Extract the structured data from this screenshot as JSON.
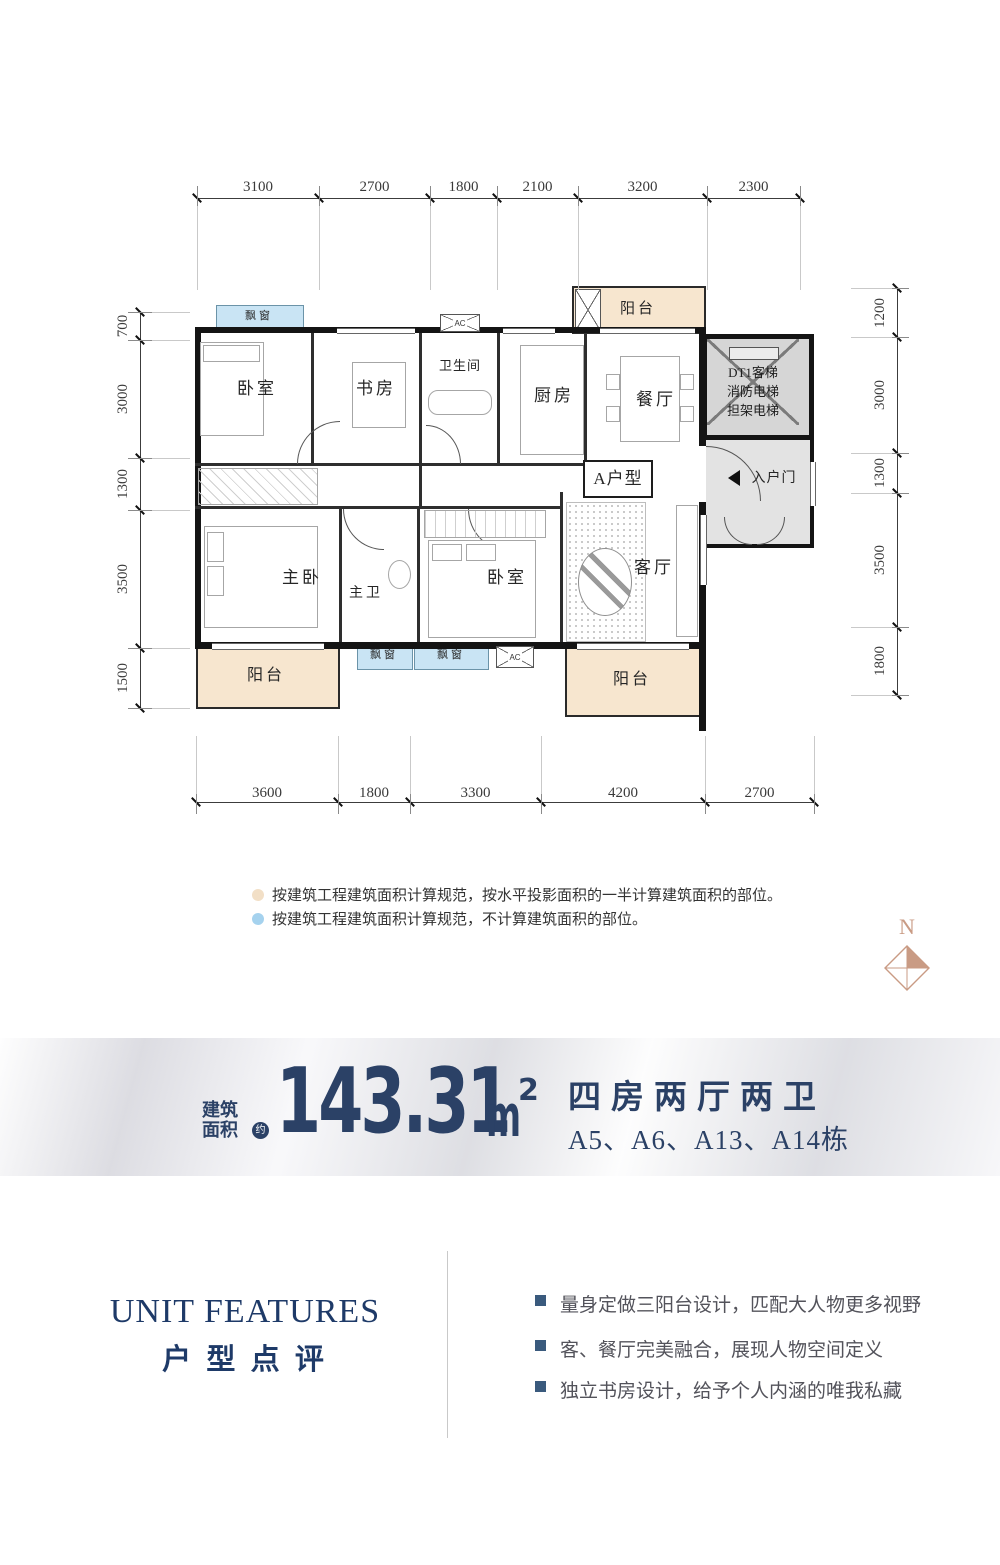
{
  "plan": {
    "unit_label": "A户型",
    "labels": {
      "bedroom": "卧室",
      "study": "书房",
      "bathroom": "卫生间",
      "kitchen": "厨房",
      "dining": "餐厅",
      "balcony": "阳台",
      "bay_window": "飘窗",
      "master_bedroom": "主卧",
      "master_bath": "主卫",
      "living": "客厅",
      "entry": "入户门",
      "ac": "AC",
      "elevator_line1": "DT1客梯",
      "elevator_line2": "消防电梯",
      "elevator_line3": "担架电梯"
    },
    "dimensions": {
      "top": [
        "3100",
        "2700",
        "1800",
        "2100",
        "3200",
        "2300"
      ],
      "bottom": [
        "3600",
        "1800",
        "3300",
        "4200",
        "2700"
      ],
      "left": [
        "700",
        "3000",
        "1300",
        "3500",
        "1500"
      ],
      "right": [
        "1200",
        "3000",
        "1300",
        "3500",
        "1800"
      ]
    }
  },
  "legend": {
    "items": [
      {
        "swatch": "half-area",
        "text": "按建筑工程建筑面积计算规范，按水平投影面积的一半计算建筑面积的部位。"
      },
      {
        "swatch": "excluded",
        "text": "按建筑工程建筑面积计算规范，不计算建筑面积的部位。"
      }
    ]
  },
  "compass": {
    "label": "N"
  },
  "banner": {
    "area_label_line1": "建筑",
    "area_label_line2": "面积",
    "approx": "约",
    "area_value": "143.31",
    "area_unit": "m",
    "area_sup": "2",
    "layout": "四房两厅两卫",
    "buildings": "A5、A6、A13、A14栋"
  },
  "features": {
    "title_en": "UNIT FEATURES",
    "title_cn": "户 型 点 评",
    "items": [
      "量身定做三阳台设计，匹配大人物更多视野",
      "客、餐厅完美融合，展现人物空间定义",
      "独立书房设计，给予个人内涵的唯我私藏"
    ]
  },
  "colors": {
    "navy": "#2b4166",
    "bay_window": "#c9e4f4",
    "balcony": "#f7e6cf",
    "lobby": "#e3e3e3",
    "elevator": "#d6d6d6",
    "legend_half": "#f2dfc6",
    "legend_excluded": "#a5d2ee",
    "compass": "#c99b84",
    "wall": "#141414",
    "bullet": "#3a5a7d",
    "feature_text": "#53535b"
  }
}
